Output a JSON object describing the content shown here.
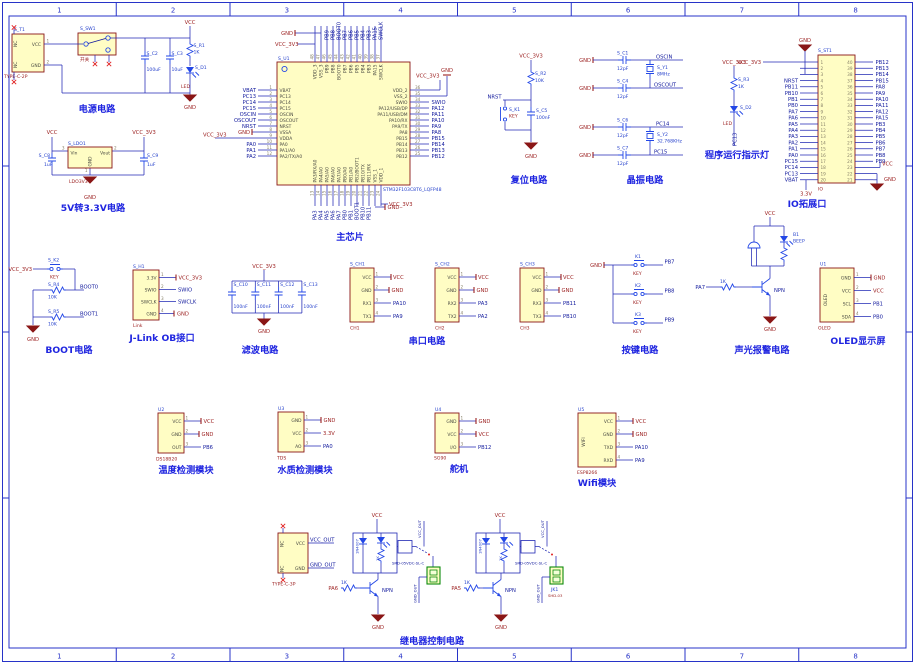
{
  "sheet": {
    "cols": [
      "1",
      "2",
      "3",
      "4",
      "5",
      "6",
      "7",
      "8"
    ]
  },
  "colors": {
    "wire": "#2028b4",
    "component_outline": "#8a1616",
    "component_fill": "#fffdc4",
    "net_label": "#10189c",
    "power_label": "#9c2121",
    "title": "#2026e0",
    "frame": "#2733c8",
    "terminal_green": "#0c8a0c"
  },
  "power": {
    "title": "电源电路",
    "t1_ref": "S_T1",
    "t1_part": "TYPE-C-2P",
    "nc": "NC",
    "vcc_pin": "VCC",
    "gnd_pin": "GND",
    "n1": "1",
    "n2": "2",
    "sw_ref": "S_SW1",
    "sw_label": "开关",
    "c2_ref": "S_C2",
    "c2_val": "100uF",
    "c3_ref": "S_C3",
    "c3_val": "10uF",
    "r1_ref": "S_R1",
    "r1_val": "1K",
    "d1_ref": "S_D1",
    "d1_val": "LED",
    "vcc": "VCC",
    "gnd": "GND"
  },
  "ldo": {
    "title": "5V转3.3V电路",
    "ref": "S_LDO1",
    "part": "LDO3V3",
    "vin": "Vin",
    "vout": "Vout",
    "gnd_pin": "GND",
    "n3": "3",
    "n2": "2",
    "n1": "1",
    "c8_ref": "S_C8",
    "c8_val": "1uF",
    "c9_ref": "S_C9",
    "c9_val": "1uF",
    "vcc": "VCC",
    "vcc33": "VCC_3V3",
    "gnd": "GND"
  },
  "chip": {
    "title": "主芯片",
    "ref": "S_U1",
    "part": "STM32F103C8T6_LQFP48",
    "gnd": "GND",
    "vcc33": "VCC_3V3",
    "left": [
      {
        "n": "1",
        "name": "VBAT",
        "net": "VBAT"
      },
      {
        "n": "2",
        "name": "PC13",
        "net": "PC13"
      },
      {
        "n": "3",
        "name": "PC14",
        "net": "PC14"
      },
      {
        "n": "4",
        "name": "PC15",
        "net": "PC15"
      },
      {
        "n": "5",
        "name": "OSCIN",
        "net": "OSCIN"
      },
      {
        "n": "6",
        "name": "OSCOUT",
        "net": "OSCOUT"
      },
      {
        "n": "7",
        "name": "NRST",
        "net": "NRST"
      },
      {
        "n": "8",
        "name": "VSSA",
        "net": ""
      },
      {
        "n": "9",
        "name": "VDDA",
        "net": ""
      },
      {
        "n": "10",
        "name": "PA0",
        "net": "PA0"
      },
      {
        "n": "11",
        "name": "PA1/A0",
        "net": "PA1"
      },
      {
        "n": "12",
        "name": "PA2/TX/A0",
        "net": "PA2"
      }
    ],
    "right": [
      {
        "n": "36",
        "name": "VDD_2",
        "net": ""
      },
      {
        "n": "35",
        "name": "VSS_2",
        "net": ""
      },
      {
        "n": "34",
        "name": "SWIO",
        "net": "SWIO"
      },
      {
        "n": "33",
        "name": "PA12/USB/DP",
        "net": "PA12"
      },
      {
        "n": "32",
        "name": "PA11/USB/DM",
        "net": "PA11"
      },
      {
        "n": "31",
        "name": "PA10/RX",
        "net": "PA10"
      },
      {
        "n": "30",
        "name": "PA9/TX",
        "net": "PA9"
      },
      {
        "n": "29",
        "name": "PA8",
        "net": "PA8"
      },
      {
        "n": "28",
        "name": "PB15",
        "net": "PB15"
      },
      {
        "n": "27",
        "name": "PB14",
        "net": "PB14"
      },
      {
        "n": "26",
        "name": "PB13",
        "net": "PB13"
      },
      {
        "n": "25",
        "name": "PB12",
        "net": "PB12"
      }
    ],
    "top": [
      {
        "n": "48",
        "name": "VDD_3",
        "net": ""
      },
      {
        "n": "47",
        "name": "VSS_3",
        "net": ""
      },
      {
        "n": "46",
        "name": "PB9",
        "net": "PB9"
      },
      {
        "n": "45",
        "name": "PB8",
        "net": "PB8"
      },
      {
        "n": "44",
        "name": "BOOT0",
        "net": "BOOT0"
      },
      {
        "n": "43",
        "name": "PB7",
        "net": "PB7"
      },
      {
        "n": "42",
        "name": "PB6",
        "net": "PB6"
      },
      {
        "n": "41",
        "name": "PB5",
        "net": "PB5"
      },
      {
        "n": "40",
        "name": "PB4",
        "net": "PB4"
      },
      {
        "n": "39",
        "name": "PB3",
        "net": "PB3"
      },
      {
        "n": "38",
        "name": "PA15",
        "net": "PA15"
      },
      {
        "n": "37",
        "name": "SWCLK",
        "net": "SWCLK"
      }
    ],
    "bottom": [
      {
        "n": "13",
        "name": "PA3/RX/A0",
        "net": "PA3"
      },
      {
        "n": "14",
        "name": "PA4/A0",
        "net": "PA4"
      },
      {
        "n": "15",
        "name": "PA5/A0",
        "net": "PA5"
      },
      {
        "n": "16",
        "name": "PA6/A0",
        "net": "PA6"
      },
      {
        "n": "17",
        "name": "PA7/A0",
        "net": "PA7"
      },
      {
        "n": "18",
        "name": "PB0/A0",
        "net": "PB0"
      },
      {
        "n": "19",
        "name": "PB1/A0",
        "net": "PB1"
      },
      {
        "n": "20",
        "name": "PB2/BOOT1",
        "net": "BOOT1"
      },
      {
        "n": "21",
        "name": "PB10/TX",
        "net": "PB10"
      },
      {
        "n": "22",
        "name": "PB11/RX",
        "net": "PB11"
      },
      {
        "n": "23",
        "name": "VSS_1",
        "net": ""
      },
      {
        "n": "24",
        "name": "VDD_1",
        "net": ""
      }
    ]
  },
  "reset": {
    "title": "复位电路",
    "vcc": "VCC_3V3",
    "r_ref": "S_R2",
    "r_val": "10K",
    "net": "NRST",
    "k_ref": "S_K1",
    "k_val": "KEY",
    "c_ref": "S_C5",
    "c_val": "100nF",
    "gnd": "GND"
  },
  "xtal": {
    "title": "晶振电路",
    "gnd": "GND",
    "groups": [
      {
        "ca_ref": "S_C1",
        "ca_val": "12pF",
        "net_a": "OSCIN",
        "y_ref": "S_Y1",
        "y_val": "8MHz",
        "cb_ref": "S_C4",
        "cb_val": "12pF",
        "net_b": "OSCOUT"
      },
      {
        "ca_ref": "S_C6",
        "ca_val": "12pF",
        "net_a": "PC14",
        "y_ref": "S_Y2",
        "y_val": "32.768KHz",
        "cb_ref": "S_C7",
        "cb_val": "12pF",
        "net_b": "PC15"
      }
    ]
  },
  "led_ind": {
    "title": "程序运行指示灯",
    "vcc": "VCC_3V3",
    "r_ref": "S_R3",
    "r_val": "1K",
    "d_ref": "S_D2",
    "d_val": "LED",
    "net": "PC13"
  },
  "io": {
    "title": "IO拓展口",
    "ref": "S_ST1",
    "part": "IO",
    "vcc33": "VCC_3V3",
    "vcc": "VCC",
    "gnd_top": "GND",
    "gnd": "GND",
    "v33": "3.3V",
    "left": [
      {
        "n": "1",
        "net": ""
      },
      {
        "n": "2",
        "net": ""
      },
      {
        "n": "3",
        "net": ""
      },
      {
        "n": "4",
        "net": "NRST"
      },
      {
        "n": "5",
        "net": "PB11"
      },
      {
        "n": "6",
        "net": "PB10"
      },
      {
        "n": "7",
        "net": "PB1"
      },
      {
        "n": "8",
        "net": "PB0"
      },
      {
        "n": "9",
        "net": "PA7"
      },
      {
        "n": "10",
        "net": "PA6"
      },
      {
        "n": "11",
        "net": "PA5"
      },
      {
        "n": "12",
        "net": "PA4"
      },
      {
        "n": "13",
        "net": "PA3"
      },
      {
        "n": "14",
        "net": "PA2"
      },
      {
        "n": "15",
        "net": "PA1"
      },
      {
        "n": "16",
        "net": "PA0"
      },
      {
        "n": "17",
        "net": "PC15"
      },
      {
        "n": "18",
        "net": "PC14"
      },
      {
        "n": "19",
        "net": "PC13"
      },
      {
        "n": "20",
        "net": "VBAT"
      }
    ],
    "right": [
      {
        "n": "40",
        "net": "PB12"
      },
      {
        "n": "39",
        "net": "PB13"
      },
      {
        "n": "38",
        "net": "PB14"
      },
      {
        "n": "37",
        "net": "PB15"
      },
      {
        "n": "36",
        "net": "PA8"
      },
      {
        "n": "35",
        "net": "PA9"
      },
      {
        "n": "34",
        "net": "PA10"
      },
      {
        "n": "33",
        "net": "PA11"
      },
      {
        "n": "32",
        "net": "PA12"
      },
      {
        "n": "31",
        "net": "PA15"
      },
      {
        "n": "30",
        "net": "PB3"
      },
      {
        "n": "29",
        "net": "PB4"
      },
      {
        "n": "28",
        "net": "PB5"
      },
      {
        "n": "27",
        "net": "PB6"
      },
      {
        "n": "26",
        "net": "PB7"
      },
      {
        "n": "25",
        "net": "PB8"
      },
      {
        "n": "24",
        "net": "PB9"
      },
      {
        "n": "23",
        "net": ""
      },
      {
        "n": "22",
        "net": ""
      },
      {
        "n": "21",
        "net": ""
      }
    ]
  },
  "boot": {
    "title": "BOOT电路",
    "vcc": "VCC_3V3",
    "k_ref": "S_K2",
    "k_val": "KEY",
    "r4_ref": "S_R4",
    "r4_val": "10K",
    "net0": "BOOT0",
    "r5_ref": "S_R5",
    "r5_val": "10K",
    "net1": "BOOT1",
    "gnd": "GND"
  },
  "jlink": {
    "title": "J-Link OB接口",
    "ref": "S_H1",
    "part": "Link",
    "pins": [
      {
        "n": "1",
        "name": "3.3V",
        "net": "VCC_3V3"
      },
      {
        "n": "2",
        "name": "SWIO",
        "net": "SWIO"
      },
      {
        "n": "3",
        "name": "SWCLK",
        "net": "SWCLK"
      },
      {
        "n": "4",
        "name": "GND",
        "net": "GND"
      }
    ]
  },
  "filter": {
    "title": "滤波电路",
    "vcc": "VCC_3V3",
    "gnd": "GND",
    "caps": [
      {
        "ref": "S_C10",
        "val": "100nF"
      },
      {
        "ref": "S_C11",
        "val": "100nF"
      },
      {
        "ref": "S_C12",
        "val": "100nF"
      },
      {
        "ref": "S_C13",
        "val": "100nF"
      }
    ]
  },
  "serial": {
    "title": "串口电路",
    "vcc": "VCC",
    "gnd": "GND",
    "vcc_pin": "VCC",
    "gnd_pin": "GND",
    "pn": [
      "1",
      "2",
      "3",
      "4"
    ],
    "chs": [
      {
        "ref": "S_CH1",
        "name": "CH1",
        "rx": "RX1",
        "tx": "TX1",
        "rx_net": "PA10",
        "tx_net": "PA9"
      },
      {
        "ref": "S_CH2",
        "name": "CH2",
        "rx": "RX2",
        "tx": "TX2",
        "rx_net": "PA3",
        "tx_net": "PA2"
      },
      {
        "ref": "S_CH3",
        "name": "CH3",
        "rx": "RX3",
        "tx": "TX3",
        "rx_net": "PB11",
        "tx_net": "PB10"
      }
    ]
  },
  "keys": {
    "title": "按键电路",
    "gnd": "GND",
    "key_val": "KEY",
    "items": [
      {
        "ref": "K1",
        "net": "PB7"
      },
      {
        "ref": "K2",
        "net": "PB8"
      },
      {
        "ref": "K3",
        "net": "PB9"
      }
    ]
  },
  "alarm": {
    "title": "声光报警电路",
    "vcc": "VCC",
    "b_ref": "B1",
    "b_val": "BEEP",
    "net": "PA7",
    "r_val": "1K",
    "npn": "NPN",
    "gnd": "GND"
  },
  "oled": {
    "title": "OLED显示屏",
    "ref": "U1",
    "part": "OLED",
    "side": "OLED",
    "pins": [
      {
        "n": "1",
        "name": "GND",
        "net": "GND"
      },
      {
        "n": "2",
        "name": "VCC",
        "net": "VCC"
      },
      {
        "n": "3",
        "name": "SCL",
        "net": "PB1"
      },
      {
        "n": "4",
        "name": "SDA",
        "net": "PB0"
      }
    ]
  },
  "temp": {
    "title": "温度检测模块",
    "ref": "U2",
    "part": "DS18B20",
    "pins": [
      {
        "n": "1",
        "name": "VCC",
        "net": "VCC"
      },
      {
        "n": "2",
        "name": "GND",
        "net": "GND"
      },
      {
        "n": "3",
        "name": "OUT",
        "net": "PB6"
      }
    ]
  },
  "water": {
    "title": "水质检测模块",
    "ref": "U3",
    "part": "TDS",
    "pins": [
      {
        "n": "1",
        "name": "GND",
        "net": "GND"
      },
      {
        "n": "2",
        "name": "VCC",
        "net": "3.3V"
      },
      {
        "n": "3",
        "name": "AO",
        "net": "PA0"
      }
    ]
  },
  "servo": {
    "title": "舵机",
    "ref": "U4",
    "part": "SG90",
    "pins": [
      {
        "n": "1",
        "name": "GND",
        "net": "GND"
      },
      {
        "n": "2",
        "name": "VCC",
        "net": "VCC"
      },
      {
        "n": "3",
        "name": "I/O",
        "net": "PB12"
      }
    ]
  },
  "wifi": {
    "title": "Wifi模块",
    "ref": "U5",
    "part": "ESP8266",
    "side": "WIFI",
    "pins": [
      {
        "n": "1",
        "name": "VCC",
        "net": "VCC"
      },
      {
        "n": "2",
        "name": "GND",
        "net": "GND"
      },
      {
        "n": "3",
        "name": "TXD",
        "net": "PA10"
      },
      {
        "n": "4",
        "name": "RXD",
        "net": "PA9"
      }
    ]
  },
  "relay": {
    "title": "继电器控制电路",
    "conn": {
      "part": "TYPE-C-3P",
      "nc": "NC",
      "vcc": "VCC",
      "gnd": "GND",
      "vcc_out": "VCC_OUT",
      "gnd_out": "GND_OUT"
    },
    "units": [
      {
        "vcc": "VCC",
        "diode": "1N4007",
        "part": "SRD-05VDC-SL-C",
        "vout": "VCC_OUT",
        "gout": "GND_OUT",
        "net": "PA6",
        "rb": "1K",
        "npn": "NPN",
        "gnd": "GND",
        "jkr": "",
        "jkp": ""
      },
      {
        "vcc": "VCC",
        "diode": "1N4007",
        "part": "SRD-05VDC-SL-C",
        "vout": "VCC_OUT",
        "gout": "GND_OUT",
        "net": "PA5",
        "rb": "1K",
        "npn": "NPN",
        "gnd": "GND",
        "jkr": "JK1",
        "jkp": "SHD-03"
      }
    ]
  },
  "stray": {
    "vcc33": "VCC_3V3"
  }
}
